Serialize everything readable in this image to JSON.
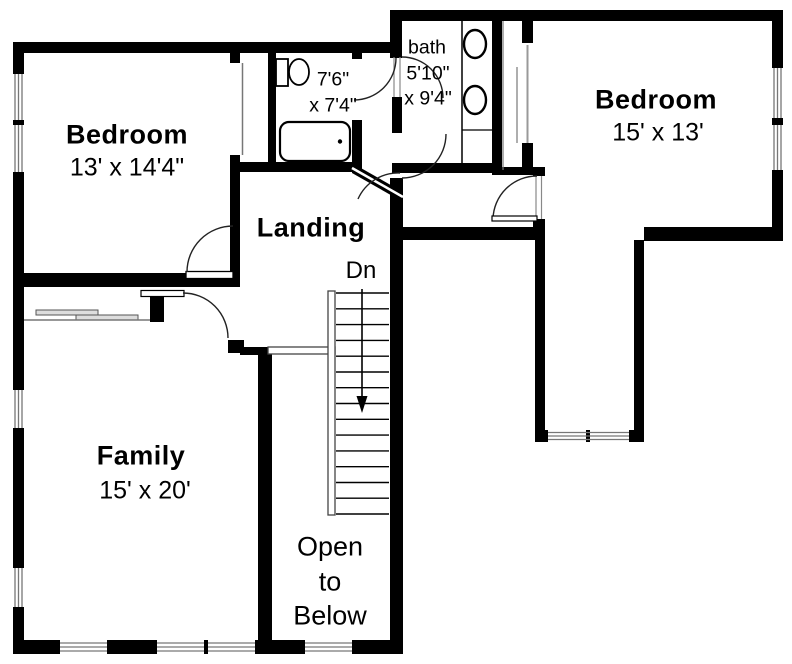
{
  "colors": {
    "wall": "#000000",
    "background": "#ffffff",
    "thin_line": "#777777"
  },
  "rooms": {
    "bedroom_left": {
      "name": "Bedroom",
      "dims": "13' x 14'4\""
    },
    "bathroom": {
      "dims_line1": "7'6\"",
      "dims_line2": "x 7'4\""
    },
    "bath": {
      "name": "bath",
      "dims_line1": "5'10\"",
      "dims_line2": "x 9'4\""
    },
    "bedroom_right": {
      "name": "Bedroom",
      "dims": "15' x 13'"
    },
    "landing": {
      "name": "Landing"
    },
    "stairs": {
      "direction_label": "Dn"
    },
    "family": {
      "name": "Family",
      "dims": "15' x 20'"
    },
    "open_to_below": {
      "line1": "Open",
      "line2": "to",
      "line3": "Below"
    }
  }
}
